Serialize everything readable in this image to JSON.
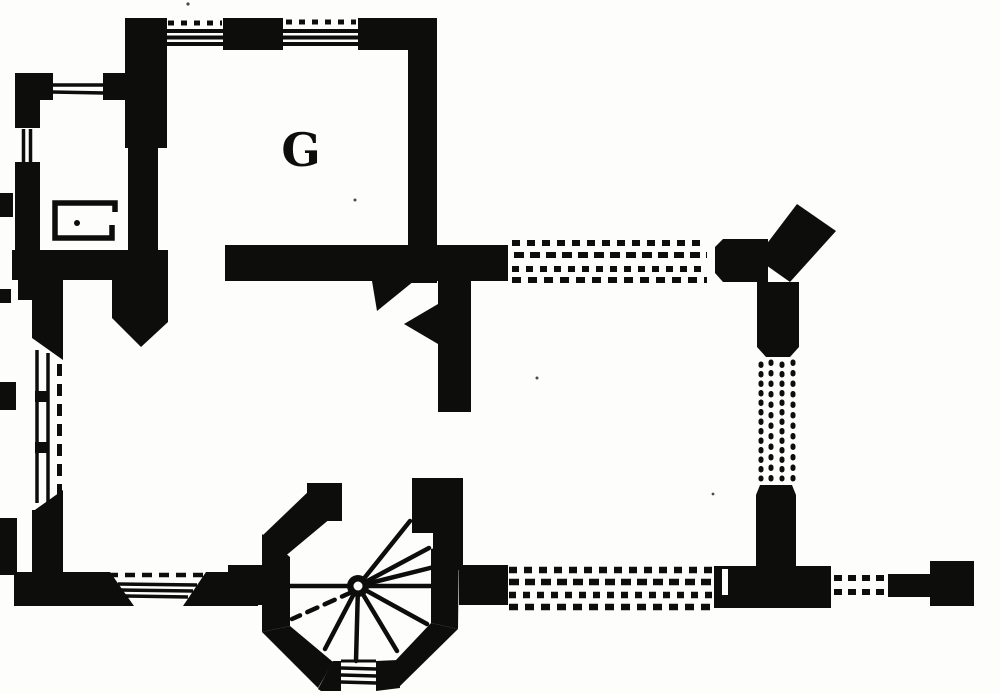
{
  "plan": {
    "room_label": "G",
    "ink_color": "#0d0d0c",
    "paper_color": "#fdfdfc",
    "features": [
      "northwest-chamber-with-hearth",
      "great-chamber-G",
      "west-hall",
      "long-west-window-with-shutter-dashes",
      "south-window-with-splayed-jambs",
      "corner-doorway-with-diagonal-passage",
      "octagonal-stair-turret-with-spiral-stair",
      "conjectural-east-wall-dotted",
      "conjectural-south-wall-dotted",
      "northeast-angle-pier",
      "southeast-pier",
      "east-gate-fragment",
      "west-edge-wall-fragments"
    ]
  }
}
